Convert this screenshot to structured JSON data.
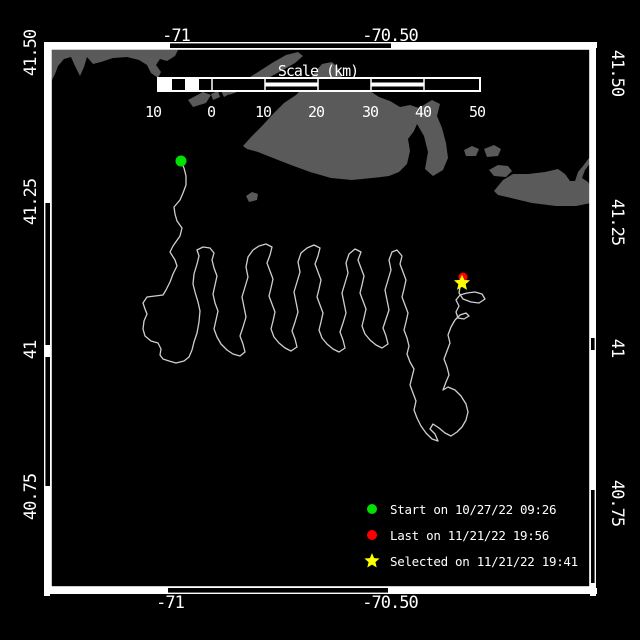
{
  "plot_title": "Drifter track map",
  "colors": {
    "background": "#000000",
    "land": "#5a5a5a",
    "track": "#cfcfcf",
    "frame": "#ffffff",
    "start": "#00e000",
    "last": "#ff0000",
    "selected": "#ffff00",
    "text": "#ffffff"
  },
  "axes": {
    "top": [
      {
        "label": "-71",
        "x": 176,
        "y": 41
      },
      {
        "label": "-70.50",
        "x": 390,
        "y": 41
      }
    ],
    "bottom": [
      {
        "label": "-71",
        "x": 170,
        "y": 608
      },
      {
        "label": "-70.50",
        "x": 390,
        "y": 608
      }
    ],
    "left": [
      {
        "label": "41.50",
        "cy": 53
      },
      {
        "label": "41.25",
        "cy": 202
      },
      {
        "label": "41",
        "cy": 350
      },
      {
        "label": "40.75",
        "cy": 497
      }
    ],
    "right": [
      {
        "label": "41.50",
        "cy": 73
      },
      {
        "label": "41.25",
        "cy": 222
      },
      {
        "label": "41",
        "cy": 348
      },
      {
        "label": "40.75",
        "cy": 503
      }
    ]
  },
  "scalebar": {
    "title": "Scale (km)",
    "title_x": 318,
    "title_y": 76,
    "x": 158,
    "y": 78,
    "w": 322,
    "h": 13,
    "white_boxes": [
      [
        159,
        172
      ],
      [
        185,
        199
      ]
    ],
    "stripes": [
      [
        265,
        318
      ],
      [
        371,
        424
      ]
    ],
    "dividers": [
      212,
      265,
      318,
      371,
      424
    ],
    "labels": [
      {
        "t": "10",
        "x": 153
      },
      {
        "t": "0",
        "x": 211
      },
      {
        "t": "10",
        "x": 263
      },
      {
        "t": "20",
        "x": 316
      },
      {
        "t": "30",
        "x": 370
      },
      {
        "t": "40",
        "x": 423
      },
      {
        "t": "50",
        "x": 477
      }
    ],
    "label_y": 117
  },
  "frame": {
    "x": 50,
    "y": 48,
    "w": 541,
    "h": 540
  },
  "zebra": {
    "outer": {
      "x": 44,
      "y": 42,
      "w": 552,
      "h": 552
    },
    "top": {
      "pos": 42,
      "thick": 6,
      "segs": [
        [
          45,
          170
        ],
        [
          391,
          597
        ]
      ]
    },
    "bottom": {
      "pos": 588,
      "thick": 6,
      "segs": [
        [
          45,
          168
        ],
        [
          388,
          597
        ]
      ]
    },
    "left": {
      "pos": 44,
      "thick": 6,
      "segs": [
        [
          42,
          203
        ],
        [
          345,
          357
        ],
        [
          486,
          596
        ]
      ]
    },
    "right": {
      "pos": 590,
      "thick": 6,
      "segs": [
        [
          42,
          338
        ],
        [
          350,
          490
        ],
        [
          583,
          596
        ]
      ]
    }
  },
  "legend": {
    "items": [
      {
        "marker": "circle",
        "color": "#00e000",
        "label": "Start on 10/27/22 09:26"
      },
      {
        "marker": "circle",
        "color": "#ff0000",
        "label": "Last on 11/21/22 19:56"
      },
      {
        "marker": "star",
        "color": "#ffff00",
        "label": "Selected on 11/21/22 19:41"
      }
    ]
  },
  "markers": {
    "start": {
      "x": 181,
      "y": 161,
      "r": 5.5
    },
    "last": {
      "x": 463,
      "y": 277,
      "r": 4.5
    },
    "selected": {
      "x": 462,
      "y": 283,
      "r": 8.5
    }
  },
  "land_polygons": [
    [
      [
        52,
        50
      ],
      [
        178,
        50
      ],
      [
        175,
        56
      ],
      [
        167,
        61
      ],
      [
        160,
        59
      ],
      [
        156,
        65
      ],
      [
        161,
        72
      ],
      [
        158,
        78
      ],
      [
        151,
        73
      ],
      [
        147,
        65
      ],
      [
        139,
        60
      ],
      [
        127,
        57
      ],
      [
        113,
        58
      ],
      [
        101,
        62
      ],
      [
        93,
        64
      ],
      [
        87,
        57
      ],
      [
        84,
        67
      ],
      [
        80,
        76
      ],
      [
        75,
        66
      ],
      [
        71,
        57
      ],
      [
        64,
        59
      ],
      [
        58,
        66
      ],
      [
        55,
        74
      ],
      [
        52,
        80
      ]
    ],
    [
      [
        298,
        52
      ],
      [
        303,
        56
      ],
      [
        295,
        63
      ],
      [
        283,
        70
      ],
      [
        270,
        77
      ],
      [
        258,
        83
      ],
      [
        247,
        88
      ],
      [
        237,
        92
      ],
      [
        229,
        95
      ],
      [
        233,
        88
      ],
      [
        245,
        80
      ],
      [
        258,
        72
      ],
      [
        272,
        63
      ],
      [
        286,
        55
      ]
    ],
    [
      [
        221,
        91
      ],
      [
        229,
        86
      ],
      [
        233,
        92
      ],
      [
        224,
        97
      ]
    ],
    [
      [
        211,
        94
      ],
      [
        218,
        91
      ],
      [
        220,
        97
      ],
      [
        213,
        100
      ]
    ],
    [
      [
        188,
        100
      ],
      [
        203,
        92
      ],
      [
        211,
        95
      ],
      [
        206,
        103
      ],
      [
        193,
        107
      ]
    ],
    [
      [
        246,
        196
      ],
      [
        252,
        192
      ],
      [
        258,
        194
      ],
      [
        257,
        200
      ],
      [
        249,
        202
      ]
    ],
    [
      [
        243,
        146
      ],
      [
        252,
        136
      ],
      [
        262,
        126
      ],
      [
        273,
        114
      ],
      [
        284,
        103
      ],
      [
        296,
        95
      ],
      [
        305,
        86
      ],
      [
        315,
        72
      ],
      [
        322,
        64
      ],
      [
        332,
        62
      ],
      [
        338,
        68
      ],
      [
        342,
        78
      ],
      [
        348,
        80
      ],
      [
        355,
        85
      ],
      [
        362,
        86
      ],
      [
        370,
        91
      ],
      [
        379,
        97
      ],
      [
        390,
        101
      ],
      [
        400,
        107
      ],
      [
        410,
        105
      ],
      [
        419,
        108
      ],
      [
        432,
        100
      ],
      [
        440,
        104
      ],
      [
        437,
        116
      ],
      [
        442,
        128
      ],
      [
        446,
        143
      ],
      [
        448,
        158
      ],
      [
        443,
        170
      ],
      [
        433,
        176
      ],
      [
        425,
        169
      ],
      [
        428,
        152
      ],
      [
        424,
        136
      ],
      [
        417,
        124
      ],
      [
        414,
        131
      ],
      [
        408,
        139
      ],
      [
        410,
        151
      ],
      [
        407,
        164
      ],
      [
        399,
        172
      ],
      [
        389,
        176
      ],
      [
        372,
        178
      ],
      [
        352,
        180
      ],
      [
        331,
        178
      ],
      [
        310,
        172
      ],
      [
        291,
        165
      ],
      [
        273,
        158
      ],
      [
        258,
        152
      ],
      [
        247,
        149
      ]
    ],
    [
      [
        464,
        150
      ],
      [
        472,
        146
      ],
      [
        479,
        149
      ],
      [
        476,
        156
      ],
      [
        466,
        156
      ]
    ],
    [
      [
        484,
        149
      ],
      [
        494,
        145
      ],
      [
        501,
        149
      ],
      [
        498,
        156
      ],
      [
        487,
        157
      ]
    ],
    [
      [
        489,
        170
      ],
      [
        498,
        165
      ],
      [
        508,
        166
      ],
      [
        512,
        171
      ],
      [
        506,
        177
      ],
      [
        494,
        176
      ]
    ],
    [
      [
        494,
        191
      ],
      [
        503,
        180
      ],
      [
        513,
        174
      ],
      [
        528,
        174
      ],
      [
        545,
        172
      ],
      [
        558,
        169
      ],
      [
        565,
        174
      ],
      [
        570,
        181
      ],
      [
        575,
        181
      ],
      [
        578,
        172
      ],
      [
        583,
        166
      ],
      [
        589,
        158
      ],
      [
        591,
        156
      ],
      [
        591,
        162
      ],
      [
        585,
        170
      ],
      [
        582,
        178
      ],
      [
        588,
        182
      ],
      [
        591,
        186
      ],
      [
        591,
        203
      ],
      [
        576,
        206
      ],
      [
        556,
        206
      ],
      [
        532,
        203
      ],
      [
        511,
        198
      ],
      [
        498,
        195
      ]
    ]
  ],
  "track_points": [
    [
      181,
      161
    ],
    [
      184,
      168
    ],
    [
      186,
      176
    ],
    [
      186,
      185
    ],
    [
      183,
      193
    ],
    [
      180,
      200
    ],
    [
      174,
      207
    ],
    [
      175,
      214
    ],
    [
      177,
      221
    ],
    [
      182,
      228
    ],
    [
      180,
      236
    ],
    [
      173,
      246
    ],
    [
      170,
      252
    ],
    [
      175,
      260
    ],
    [
      177,
      266
    ],
    [
      173,
      274
    ],
    [
      170,
      282
    ],
    [
      166,
      290
    ],
    [
      163,
      295
    ],
    [
      147,
      297
    ],
    [
      143,
      303
    ],
    [
      145,
      309
    ],
    [
      147,
      314
    ],
    [
      144,
      321
    ],
    [
      143,
      329
    ],
    [
      145,
      336
    ],
    [
      151,
      341
    ],
    [
      158,
      343
    ],
    [
      161,
      349
    ],
    [
      160,
      355
    ],
    [
      163,
      359
    ],
    [
      169,
      361
    ],
    [
      176,
      363
    ],
    [
      184,
      361
    ],
    [
      189,
      357
    ],
    [
      192,
      350
    ],
    [
      194,
      342
    ],
    [
      197,
      333
    ],
    [
      199,
      322
    ],
    [
      200,
      311
    ],
    [
      198,
      302
    ],
    [
      195,
      292
    ],
    [
      193,
      284
    ],
    [
      194,
      274
    ],
    [
      197,
      264
    ],
    [
      199,
      256
    ],
    [
      197,
      250
    ],
    [
      203,
      247
    ],
    [
      210,
      248
    ],
    [
      214,
      253
    ],
    [
      212,
      260
    ],
    [
      214,
      268
    ],
    [
      217,
      276
    ],
    [
      215,
      285
    ],
    [
      213,
      294
    ],
    [
      215,
      303
    ],
    [
      218,
      311
    ],
    [
      216,
      320
    ],
    [
      214,
      329
    ],
    [
      217,
      337
    ],
    [
      221,
      344
    ],
    [
      227,
      350
    ],
    [
      233,
      354
    ],
    [
      240,
      356
    ],
    [
      245,
      352
    ],
    [
      243,
      344
    ],
    [
      240,
      336
    ],
    [
      243,
      327
    ],
    [
      246,
      317
    ],
    [
      244,
      307
    ],
    [
      242,
      297
    ],
    [
      245,
      287
    ],
    [
      248,
      277
    ],
    [
      246,
      267
    ],
    [
      248,
      257
    ],
    [
      253,
      250
    ],
    [
      259,
      246
    ],
    [
      266,
      244
    ],
    [
      272,
      247
    ],
    [
      270,
      255
    ],
    [
      267,
      263
    ],
    [
      270,
      271
    ],
    [
      273,
      279
    ],
    [
      271,
      288
    ],
    [
      269,
      296
    ],
    [
      272,
      304
    ],
    [
      275,
      312
    ],
    [
      273,
      321
    ],
    [
      271,
      329
    ],
    [
      274,
      337
    ],
    [
      279,
      343
    ],
    [
      285,
      348
    ],
    [
      291,
      351
    ],
    [
      297,
      347
    ],
    [
      295,
      339
    ],
    [
      292,
      331
    ],
    [
      295,
      322
    ],
    [
      298,
      312
    ],
    [
      296,
      302
    ],
    [
      294,
      292
    ],
    [
      297,
      282
    ],
    [
      300,
      272
    ],
    [
      298,
      262
    ],
    [
      301,
      253
    ],
    [
      307,
      248
    ],
    [
      314,
      245
    ],
    [
      320,
      248
    ],
    [
      318,
      256
    ],
    [
      315,
      264
    ],
    [
      318,
      272
    ],
    [
      321,
      280
    ],
    [
      319,
      289
    ],
    [
      317,
      297
    ],
    [
      320,
      305
    ],
    [
      323,
      313
    ],
    [
      321,
      322
    ],
    [
      319,
      330
    ],
    [
      322,
      338
    ],
    [
      327,
      344
    ],
    [
      333,
      349
    ],
    [
      339,
      352
    ],
    [
      345,
      348
    ],
    [
      343,
      340
    ],
    [
      340,
      332
    ],
    [
      343,
      323
    ],
    [
      346,
      313
    ],
    [
      344,
      303
    ],
    [
      342,
      293
    ],
    [
      345,
      283
    ],
    [
      348,
      273
    ],
    [
      346,
      263
    ],
    [
      349,
      254
    ],
    [
      355,
      249
    ],
    [
      361,
      252
    ],
    [
      358,
      260
    ],
    [
      361,
      268
    ],
    [
      364,
      276
    ],
    [
      362,
      285
    ],
    [
      360,
      293
    ],
    [
      363,
      301
    ],
    [
      366,
      309
    ],
    [
      364,
      318
    ],
    [
      362,
      326
    ],
    [
      365,
      334
    ],
    [
      370,
      340
    ],
    [
      376,
      345
    ],
    [
      382,
      348
    ],
    [
      388,
      344
    ],
    [
      386,
      336
    ],
    [
      383,
      328
    ],
    [
      386,
      319
    ],
    [
      389,
      310
    ],
    [
      387,
      300
    ],
    [
      385,
      290
    ],
    [
      388,
      280
    ],
    [
      391,
      270
    ],
    [
      389,
      260
    ],
    [
      392,
      252
    ],
    [
      397,
      250
    ],
    [
      402,
      256
    ],
    [
      400,
      264
    ],
    [
      403,
      272
    ],
    [
      406,
      280
    ],
    [
      404,
      289
    ],
    [
      402,
      297
    ],
    [
      405,
      305
    ],
    [
      408,
      313
    ],
    [
      406,
      322
    ],
    [
      404,
      330
    ],
    [
      407,
      338
    ],
    [
      409,
      346
    ],
    [
      407,
      354
    ],
    [
      410,
      362
    ],
    [
      414,
      369
    ],
    [
      412,
      377
    ],
    [
      410,
      385
    ],
    [
      413,
      393
    ],
    [
      416,
      401
    ],
    [
      414,
      410
    ],
    [
      417,
      418
    ],
    [
      421,
      426
    ],
    [
      426,
      433
    ],
    [
      432,
      439
    ],
    [
      438,
      441
    ],
    [
      435,
      434
    ],
    [
      430,
      429
    ],
    [
      433,
      424
    ],
    [
      439,
      428
    ],
    [
      445,
      433
    ],
    [
      451,
      436
    ],
    [
      457,
      432
    ],
    [
      462,
      427
    ],
    [
      466,
      420
    ],
    [
      468,
      412
    ],
    [
      466,
      404
    ],
    [
      461,
      396
    ],
    [
      455,
      390
    ],
    [
      448,
      387
    ],
    [
      443,
      390
    ],
    [
      446,
      382
    ],
    [
      449,
      375
    ],
    [
      447,
      367
    ],
    [
      444,
      359
    ],
    [
      447,
      351
    ],
    [
      450,
      343
    ],
    [
      448,
      335
    ],
    [
      451,
      327
    ],
    [
      455,
      320
    ],
    [
      460,
      315
    ],
    [
      466,
      313
    ],
    [
      469,
      316
    ],
    [
      464,
      319
    ],
    [
      458,
      318
    ],
    [
      456,
      312
    ],
    [
      459,
      306
    ],
    [
      456,
      300
    ],
    [
      460,
      295
    ],
    [
      467,
      293
    ],
    [
      475,
      292
    ],
    [
      482,
      294
    ],
    [
      485,
      299
    ],
    [
      479,
      303
    ],
    [
      471,
      302
    ],
    [
      463,
      299
    ],
    [
      459,
      293
    ],
    [
      460,
      287
    ],
    [
      462,
      282
    ]
  ]
}
